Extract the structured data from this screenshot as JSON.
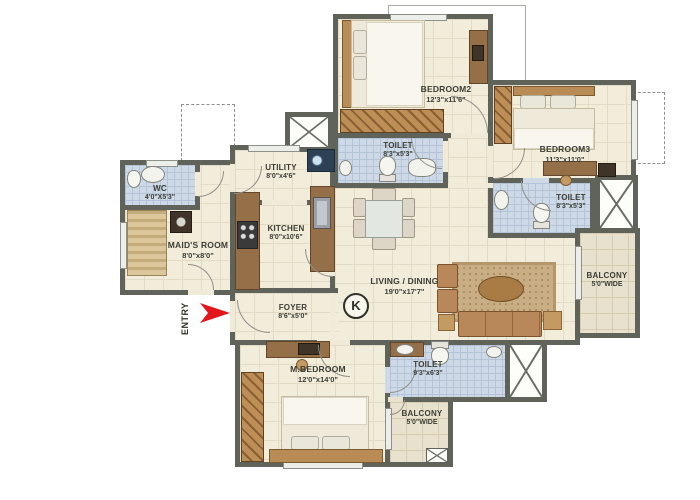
{
  "plan_title": "Apartment Floor Plan",
  "colors": {
    "wall": "#60635a",
    "floor": "#f2ecdb",
    "toilet_floor": "#cdd9e6",
    "balcony_floor": "#e8e1cd",
    "wood": "#946f47",
    "accent_red": "#e3161c"
  },
  "rooms": [
    {
      "name": "BEDROOM2",
      "dims": "12'3\"x11'6\""
    },
    {
      "name": "BEDROOM3",
      "dims": "11'3\"x11'0\""
    },
    {
      "name": "TOILET",
      "dims": "8'3\"x5'3\""
    },
    {
      "name": "TOILET",
      "dims": "8'3\"x5'3\""
    },
    {
      "name": "TOILET",
      "dims": "9'3\"x6'3\""
    },
    {
      "name": "WC",
      "dims": "4'0\"X5'3\""
    },
    {
      "name": "MAID'S ROOM",
      "dims": "8'0\"x8'0\""
    },
    {
      "name": "UTILITY",
      "dims": "8'0\"x4'6\""
    },
    {
      "name": "KITCHEN",
      "dims": "8'0\"x10'6\""
    },
    {
      "name": "LIVING / DINING",
      "dims": "19'0\"x17'7\""
    },
    {
      "name": "FOYER",
      "dims": "8'6\"x5'0\""
    },
    {
      "name": "M.BEDROOM",
      "dims": "12'0\"x14'0\""
    },
    {
      "name": "BALCONY",
      "dims": "5'0\"WIDE"
    },
    {
      "name": "BALCONY",
      "dims": "5'0\"WIDE"
    }
  ],
  "entry": {
    "label": "ENTRY"
  },
  "compass": {
    "label": "K"
  }
}
